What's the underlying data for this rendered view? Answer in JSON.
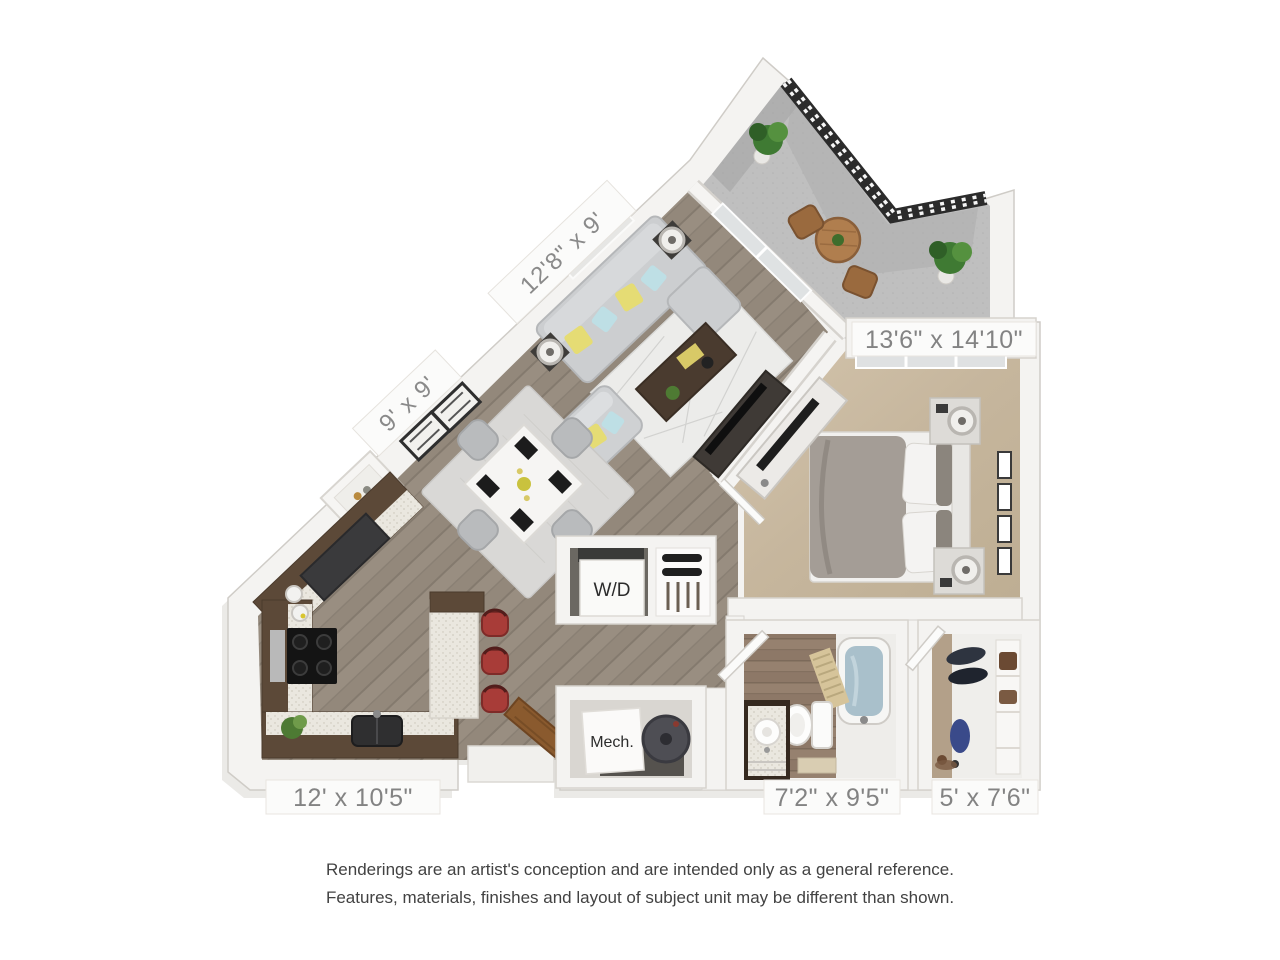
{
  "floor_plan": {
    "labels": {
      "living_room": "12'8\" x 9'",
      "dining_nook": "9' x 9'",
      "bedroom": "13'6\" x 14'10\"",
      "kitchen": "12' x 10'5\"",
      "bathroom": "7'2\" x 9'5\"",
      "closet": "5' x 7'6\"",
      "washer_dryer": "W/D",
      "mechanical": "Mech."
    },
    "colors": {
      "wall": "#f4f3f1",
      "wood_floor": "#988d80",
      "carpet": "#c8b9a1",
      "balcony_concrete": "#bdbdbd",
      "cabinet_wood": "#5c4938",
      "stool_red": "#a83c38",
      "railing": "#2b2b2b",
      "label_text": "#838383"
    }
  },
  "disclaimer": {
    "line1": "Renderings are an artist's conception and are intended only as a general reference.",
    "line2": "Features, materials, finishes and layout of subject unit may be different than shown."
  }
}
